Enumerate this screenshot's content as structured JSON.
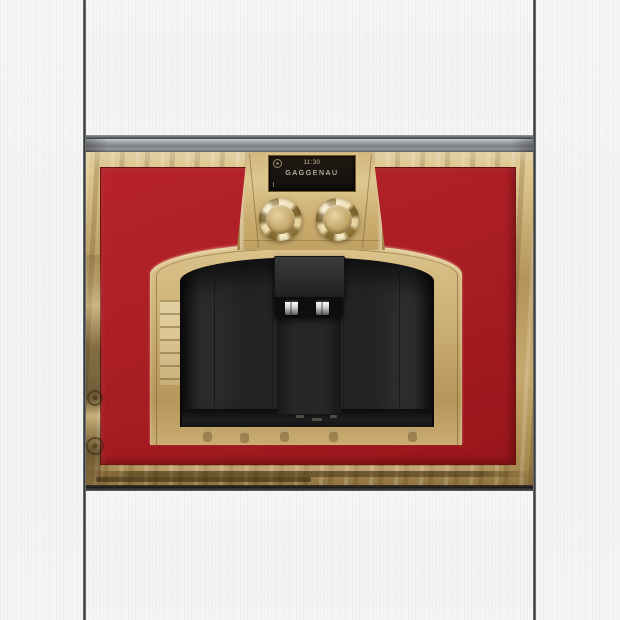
{
  "scene": {
    "description": "Built-in gold and red coffee machine recessed into white kitchen cabinetry"
  },
  "display": {
    "time": "11:30",
    "brand": "GAGGENAU"
  },
  "colors": {
    "accent_red": "#a81d22",
    "gold": "#c8ab70",
    "gold_bright": "#e5d3a2",
    "recess_black": "#242424",
    "trim_gray": "#8f9295",
    "cabinet_white": "#f5f5f4"
  },
  "icons": {
    "clock": "clock-icon"
  }
}
